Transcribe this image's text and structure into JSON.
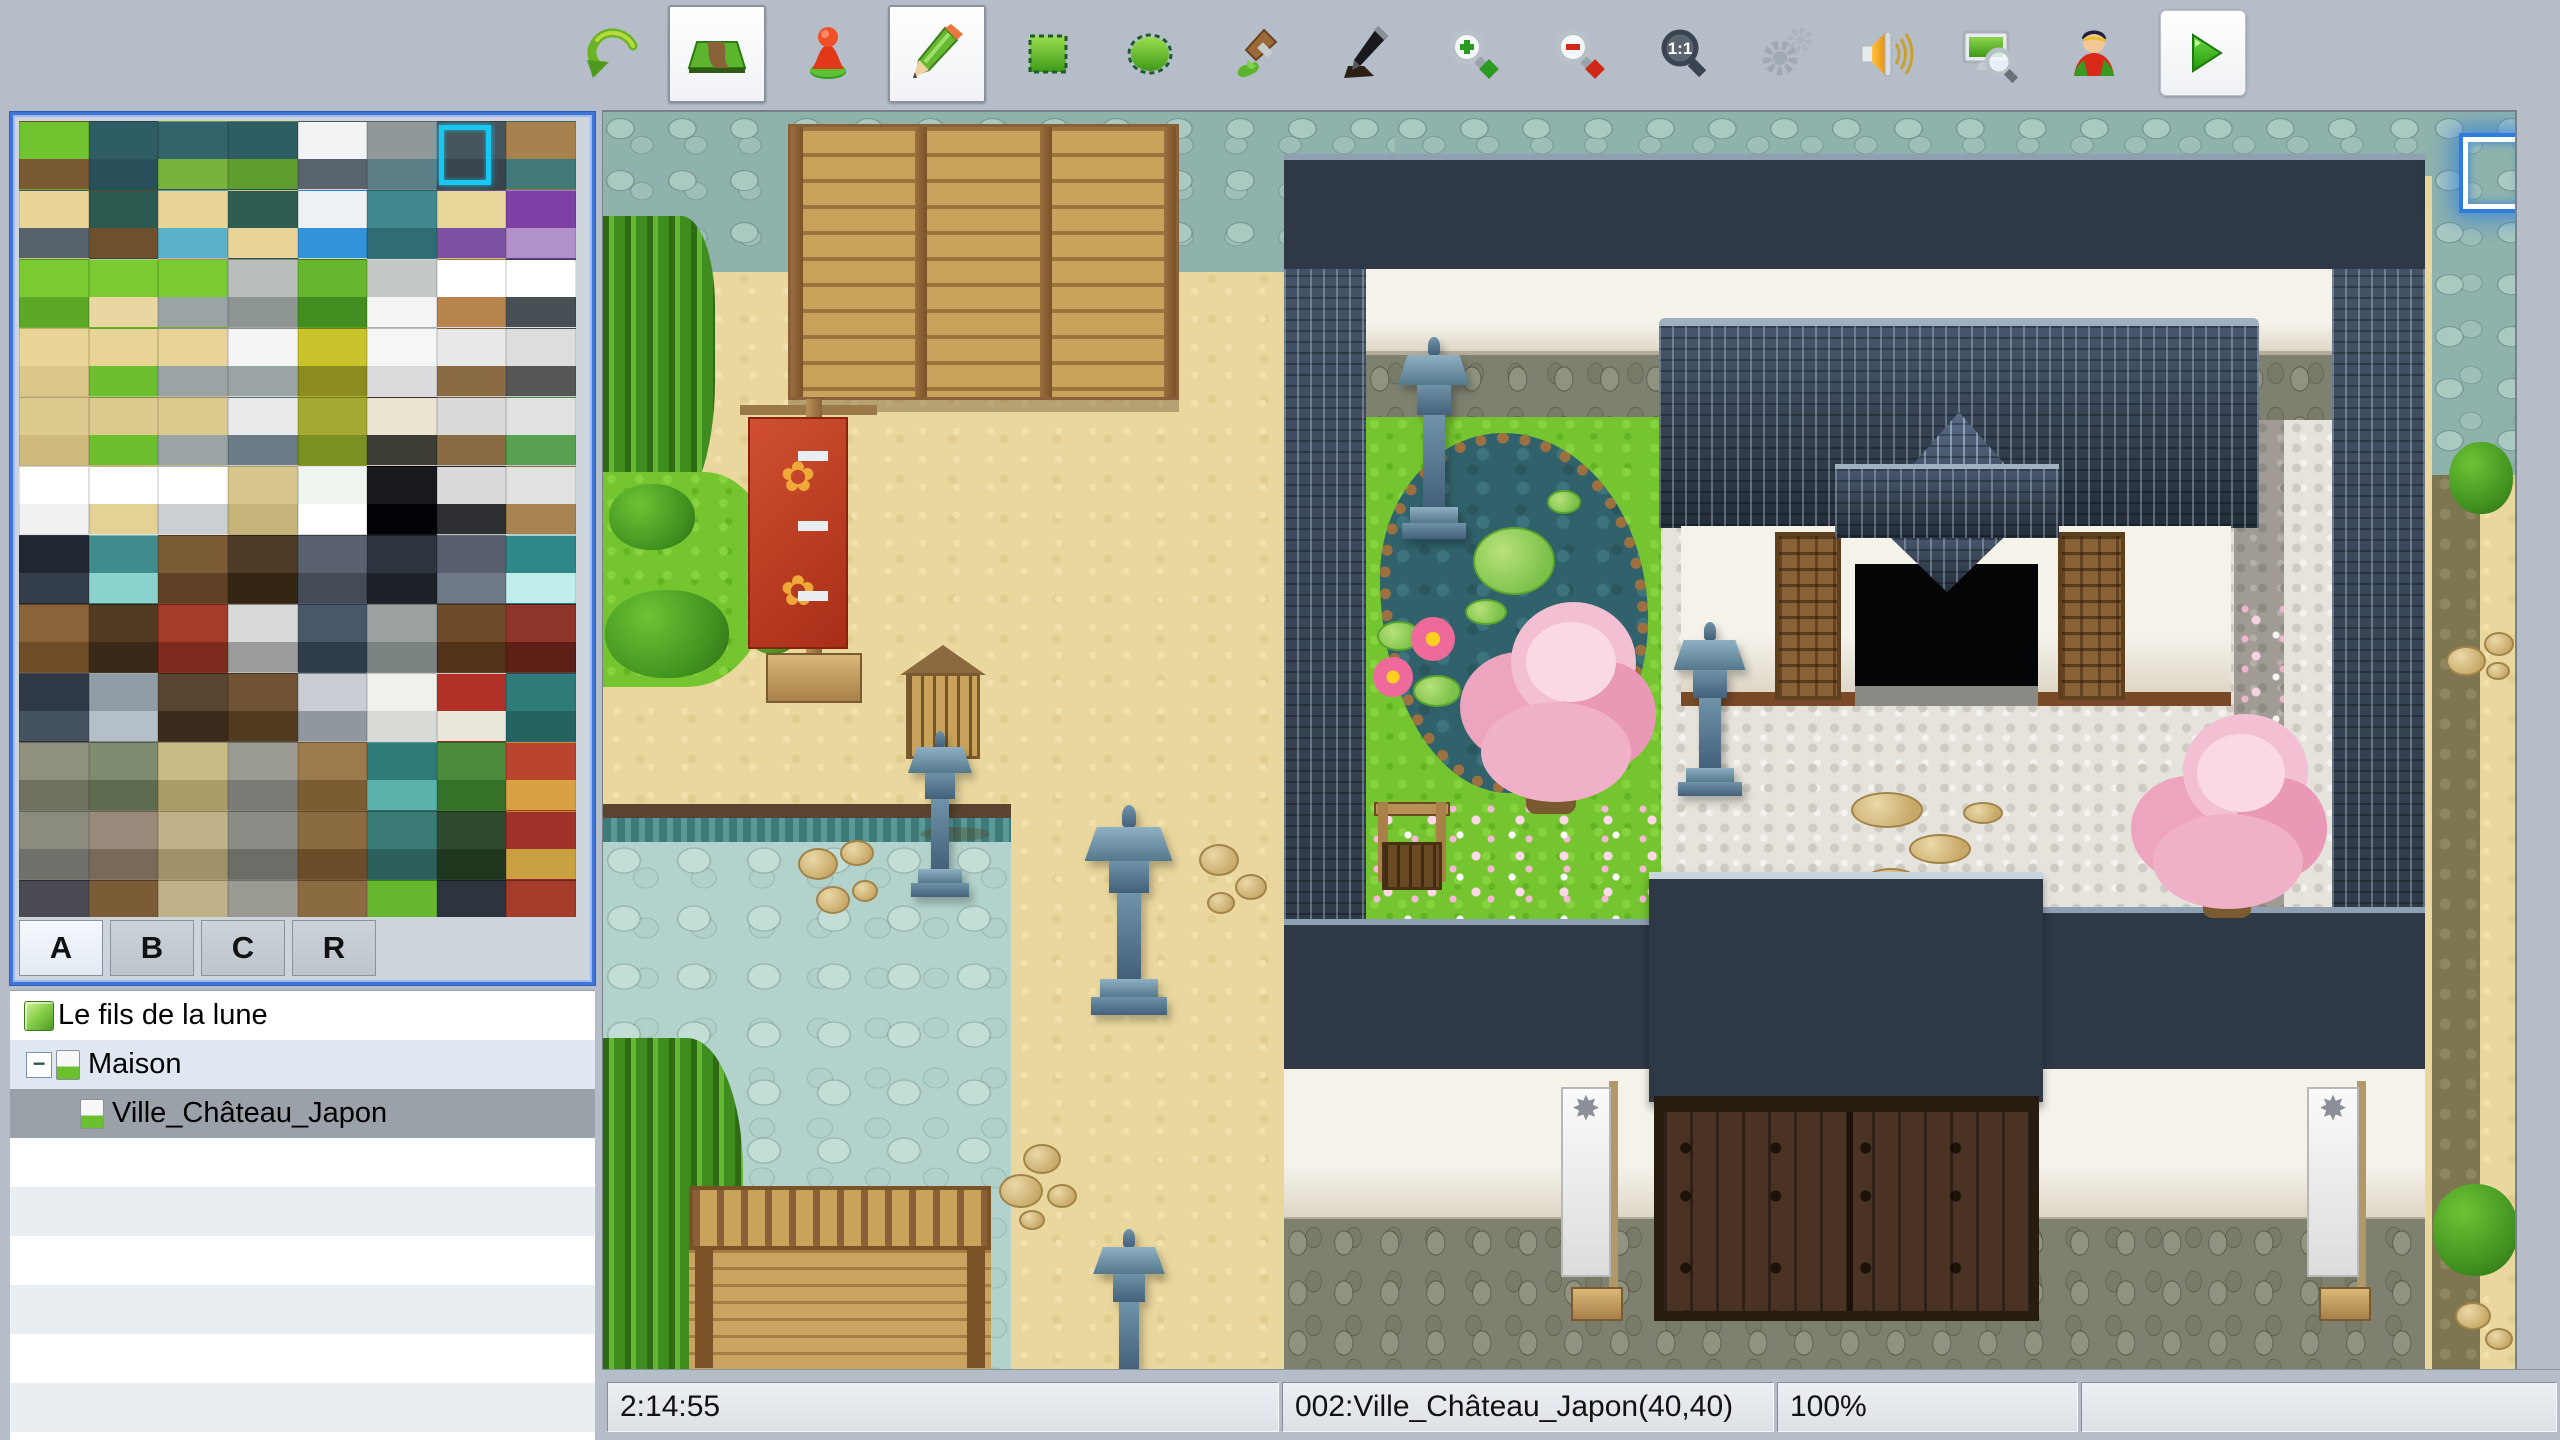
{
  "toolbar": {
    "icons": [
      {
        "name": "undo-icon"
      },
      {
        "name": "map-edit-mode-icon",
        "active": true
      },
      {
        "name": "event-edit-mode-icon"
      },
      {
        "name": "pencil-tool-icon",
        "active": true
      },
      {
        "name": "rectangle-tool-icon"
      },
      {
        "name": "ellipse-tool-icon"
      },
      {
        "name": "flood-fill-tool-icon"
      },
      {
        "name": "shadow-pen-tool-icon"
      },
      {
        "name": "zoom-in-icon"
      },
      {
        "name": "zoom-out-icon"
      },
      {
        "name": "actual-size-icon"
      },
      {
        "name": "gears-icon",
        "disabled": true
      },
      {
        "name": "speaker-icon"
      },
      {
        "name": "screen-search-icon"
      },
      {
        "name": "character-icon"
      },
      {
        "name": "playtest-icon",
        "active": true
      }
    ],
    "actual_size_label": "1:1"
  },
  "palette": {
    "tabs": [
      {
        "label": "A",
        "active": true
      },
      {
        "label": "B",
        "active": false
      },
      {
        "label": "C",
        "active": false
      },
      {
        "label": "R",
        "active": false
      }
    ],
    "selected_tile": {
      "row": 0,
      "col": 6
    },
    "tiles": [
      [
        "#6fc32e|#7a5a35",
        "#2e5d63|#27505a",
        "#33646a|#78b43d",
        "#2e5d63|#5d9e2f",
        "#f2f3f4|#5a646e",
        "#90989a|#5d7e86",
        "#47555c|#39454c",
        "#a7824f|#417a78"
      ],
      [
        "#e7d496|#57636c",
        "#2b5a50|#6e502f",
        "#e7d496|#5ab2ca",
        "#2e5d52|#e7d496",
        "#eef1f3|#3293da",
        "#40898f|#2e6d74",
        "#e8d79b|#7c50a2",
        "#7d41a5|#b291cb"
      ],
      [
        "#7aca31|#5ca827",
        "#7aca31|#e8d7a1",
        "#7aca31|#9ba4a5",
        "#babeba|#8e9692",
        "#66b72d|#418f20",
        "#c4c8c4|#f3f4f3",
        "#ffffff|#b6844c",
        "#ffffff|#465055"
      ],
      [
        "#e7d496|#dac789",
        "#e7d496|#6cc02e",
        "#e7d496|#9ba4a5",
        "#f3f4f3|#9ba4a5",
        "#c9c42c|#8b8b20",
        "#f5f6f6|#d9dbdc",
        "#e9e9e9|#8b6b43",
        "#dddddd|#565656"
      ],
      [
        "#ddca8f|#ceba7f",
        "#ddca8f|#6cc02e",
        "#ddca8f|#9ba4a5",
        "#e9eaeb|#6c7c86",
        "#a4a933|#7b9023",
        "#eae4d1|#3d3d35",
        "#dadada|#8b6b43",
        "#e1e1e1|#58a151"
      ],
      [
        "#ffffff|#f1f1f1",
        "#ffffff|#e3d294",
        "#ffffff|#cacfd3",
        "#d6c68b|#c4b479",
        "#eff5ef|#ffffff",
        "#18191d|#010307",
        "#dadada|#2d2f32",
        "#e1e1e1|#a68350"
      ],
      [
        "#212730|#353f4b",
        "#3f8d8d|#8bd1cd",
        "#7c5b37|#5e4124",
        "#4f3c27|#342513",
        "#5b626f|#444b57",
        "#2d343e|#1c2127",
        "#565f6b|#6f7985",
        "#2f8887|#c0efeb"
      ],
      [
        "#8b6339|#6f4d29",
        "#523b23|#3a2918",
        "#a33c2b|#7d2b1d",
        "#d9d9d9|#9b9b9b",
        "#475969|#2f3d4b",
        "#9ba1a1|#7b8383",
        "#6f4b2b|#513319",
        "#8f3529|#5d2017"
      ],
      [
        "#2f3945|#455361",
        "#909ba5|#b5bfc7",
        "#594431|#3b2b1d",
        "#6f5334|#513b21",
        "#c9cdd3|#90989f",
        "#f0f0ed|#d9d9d5",
        "#b13129|#e9e5db",
        "#2f7b79|#256361"
      ],
      [
        "#90907f|#707161",
        "#7e8b6e|#5e6b51",
        "#caba83|#aa9b67",
        "#9b9b93|#7b7b75",
        "#9b7b4b|#7b5d33",
        "#2f7b79|#5bb1ab",
        "#4b8b3b|#367129",
        "#b9452f|#d9a141"
      ],
      [
        "#8b8b7f|#71716b",
        "#99897b|#796959",
        "#c1b189|#a19169",
        "#898b85|#6b6d67",
        "#8b6b41|#6b4d29",
        "#3b7b75|#2d5f5b",
        "#2f4b2f|#1f361f",
        "#a13129|#c9a141"
      ],
      [
        "#4a4a52|#33333b",
        "#7c5b37|#5e4124",
        "#c1b189|#a19169",
        "#9b9b93|#7b7b75",
        "#8b6b41|#6b4d29",
        "#66b72d|#418f20",
        "#2d343e|#1c2127",
        "#a33c2b|#7d2b1d"
      ]
    ]
  },
  "map_tree": {
    "project_label": "Le fils de la lune",
    "items": [
      {
        "label": "Maison",
        "level": 1,
        "expander": "−",
        "selected": false
      },
      {
        "label": "Ville_Château_Japon",
        "level": 2,
        "selected": true
      }
    ],
    "empty_rows": 7
  },
  "status_bar": {
    "time": "2:14:55",
    "map_info": "002:Ville_Château_Japon(40,40)",
    "zoom_level": "100%",
    "extra": ""
  },
  "scene": {
    "name": "Ville_Château_Japon map view",
    "banner_emblem": "✿",
    "white_banner_emblem": "✸",
    "colors": {
      "chrome": "#b5bdc8",
      "sand": "#e9d79e",
      "cobble": "#8fb3ac",
      "cobble_light": "#b2d2cb",
      "grass": "#74c52f",
      "pond": "#31626b",
      "pebble": "#e6e3dc",
      "roof": "#2e3945",
      "stone_base": "#7e8170",
      "wood": "#c9a35c",
      "banner_red": "#c23c28",
      "banner_gold": "#f0a838",
      "tree_pink": "#f0b0c8",
      "cursor_blue": "#2e7ce0",
      "selection_cyan": "#18c8f2"
    }
  }
}
